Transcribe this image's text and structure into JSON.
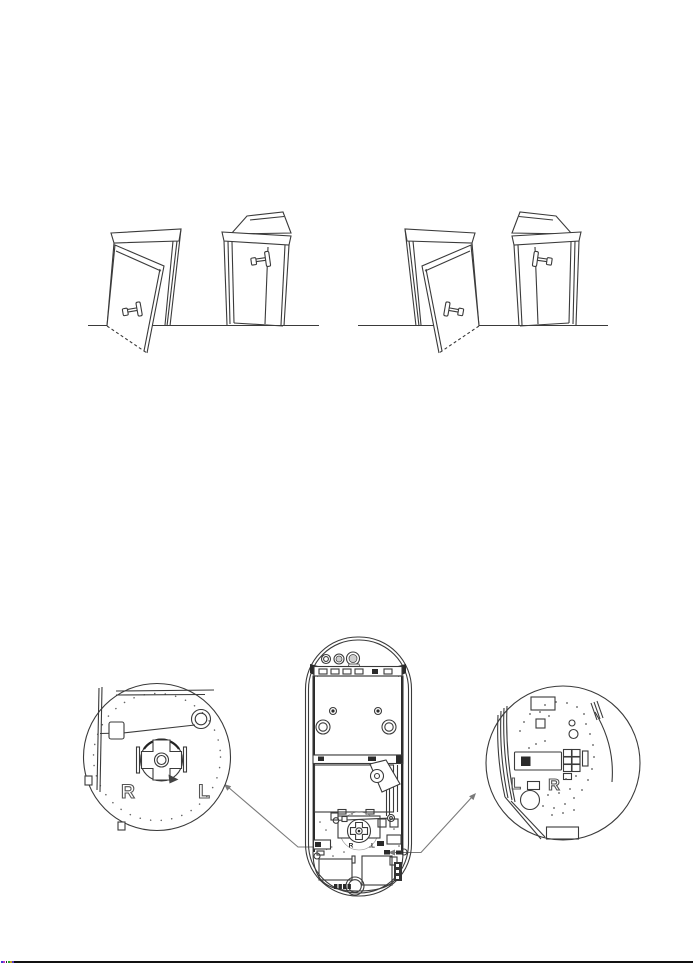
{
  "page": {
    "background": "#ffffff",
    "ink_color": "#3a3a3a",
    "leader_color": "#7a7a7a",
    "footer_rule_color": "#111111",
    "footer_mark_colors": [
      "#3b3bd4",
      "#c03ac0",
      "#2a2a2a",
      "#2fa02f",
      "#c8a020",
      "#5a3ac0"
    ]
  },
  "door_figures": {
    "pair_left": [
      "door-open-outward",
      "door-open-inward"
    ],
    "pair_right": [
      "door-open-outward-mirrored",
      "door-open-inward-mirrored"
    ]
  },
  "left_callout": {
    "label_left": "R",
    "label_right": "L"
  },
  "right_callout": {
    "label_left": "L",
    "label_right": "R"
  },
  "device_pcb": {
    "label_left": "R",
    "label_right": "L"
  }
}
